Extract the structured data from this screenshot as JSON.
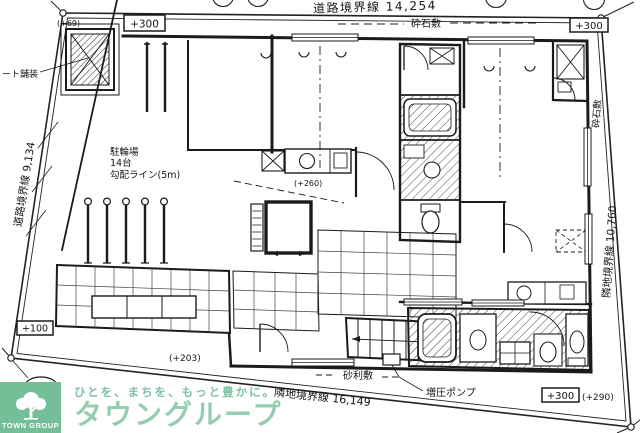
{
  "drawing": {
    "dims": {
      "top": "道路境界線 14,254",
      "left": "道路境界線 9,134",
      "right": "隣地境界線 10,760",
      "bottom": "隣地境界線 16,149"
    },
    "levels": {
      "tl_box": "+300",
      "tr_box": "+300",
      "br_box": "+300",
      "br_paren": "(+290)",
      "entrance_box": "+100",
      "tl_paren": "(+69)",
      "approach_paren": "(+203)",
      "hall_paren": "(+260)",
      "road_point": "-37"
    },
    "surfaces": {
      "gravel_top": "砕石敷",
      "gravel_right": "砕石敷",
      "gravel_bottom": "砂利敷",
      "pavement_left": "ート舗装"
    },
    "equipment": {
      "booster_pump": "増圧ポンプ"
    },
    "bike": {
      "title": "駐輪場",
      "count": "14台",
      "slope": "勾配ライン(5m)"
    }
  },
  "logo": {
    "mark_text": "TOWN GROUP",
    "tagline": "ひとを、まちを、もっと豊かに。",
    "brand": "タウングループ"
  },
  "colors": {
    "ink": "#1b1b1b",
    "paper": "#ffffff",
    "logo_green": "#74bf98",
    "logo_text_green": "#8cc9aa"
  }
}
